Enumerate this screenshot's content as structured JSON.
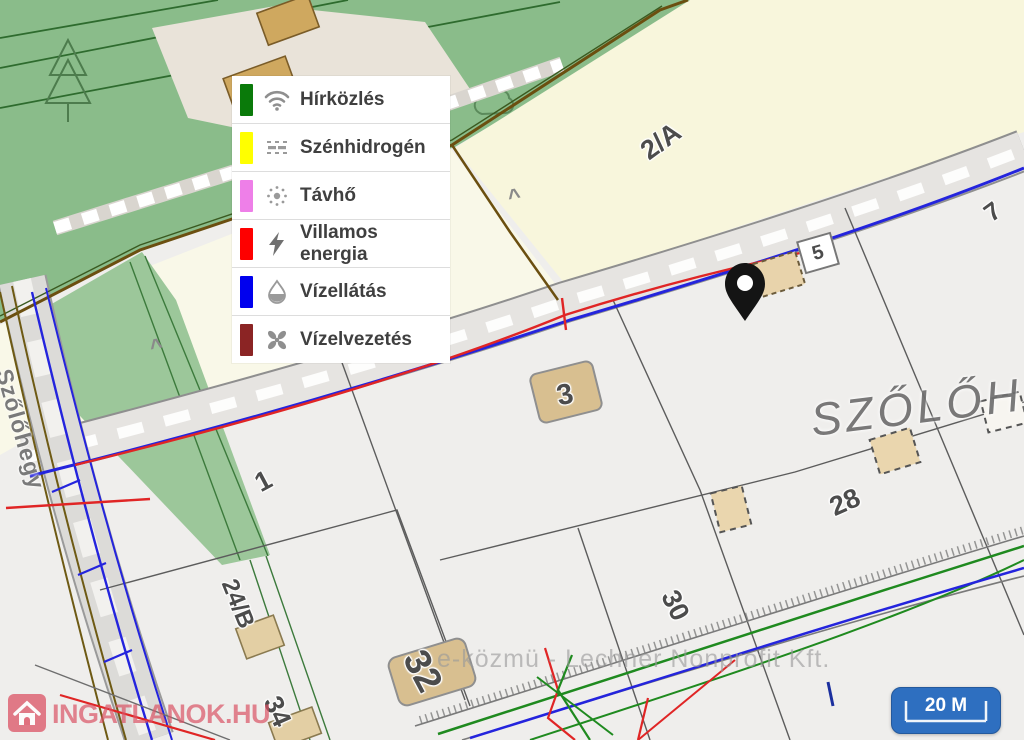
{
  "legend": {
    "items": [
      {
        "label": "Hírközlés",
        "color": "#0a7a0a",
        "icon": "wifi-icon"
      },
      {
        "label": "Szénhidrogén",
        "color": "#ffff00",
        "icon": "steam-icon"
      },
      {
        "label": "Távhő",
        "color": "#ee7fe8",
        "icon": "sun-icon"
      },
      {
        "label": "Villamos energia",
        "color": "#fe0000",
        "icon": "lightning-icon"
      },
      {
        "label": "Vízellátás",
        "color": "#0000ee",
        "icon": "droplet-icon"
      },
      {
        "label": "Vízelvezetés",
        "color": "#8b2424",
        "icon": "fan-icon"
      }
    ]
  },
  "map": {
    "parcels": [
      "2/A",
      "5",
      "7",
      "3",
      "1",
      "28",
      "30",
      "24/B",
      "32",
      "34"
    ],
    "street_label": "Szőlőhegy",
    "area_label": "SZŐLŐHE",
    "caret": "^",
    "attribution": "e-közmü - Lechner Nonprofit Kft.",
    "colors": {
      "vegetation_green": "#8abc8a",
      "parcel_cream": "#f8f6dc",
      "parcel_gray": "#efeeec",
      "road_fill": "#e6e4e1",
      "utility_water_blue": "#2424dd",
      "utility_power_red": "#e02525",
      "utility_telecom_green": "#1f8a1f",
      "boundary_olive": "#6b4f10"
    }
  },
  "scale": {
    "label": "20 M",
    "color": "#2e6fc0"
  },
  "brand": {
    "text": "INGATLANOK.HU"
  }
}
